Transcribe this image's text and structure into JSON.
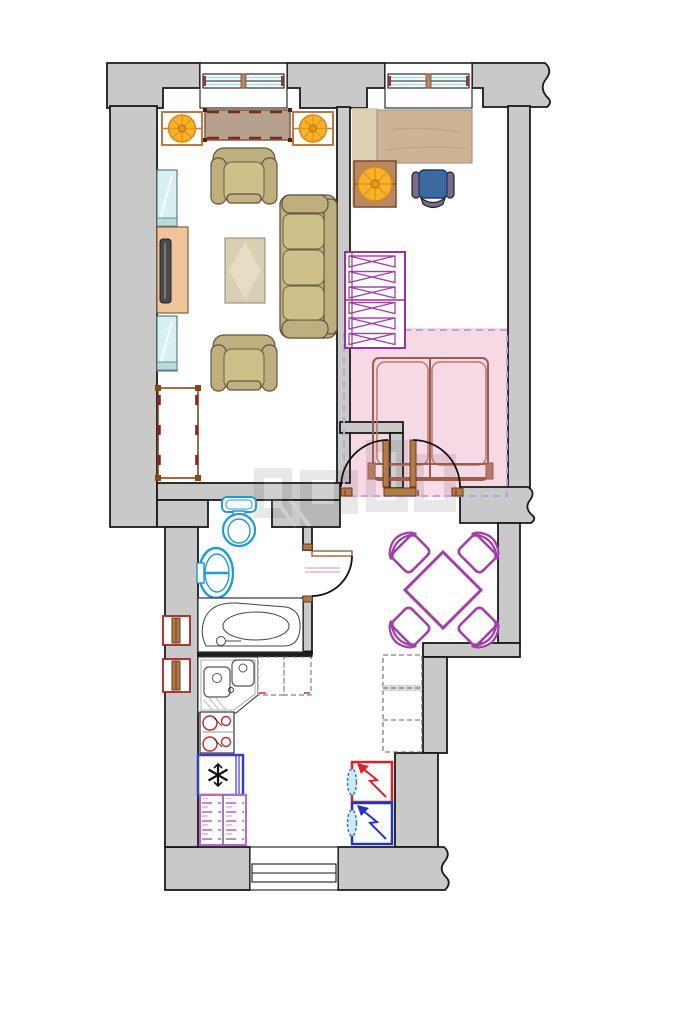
{
  "document": {
    "kind": "apartment floor plan drawing",
    "page_background": "#ffffff",
    "text_labels": []
  },
  "plan": {
    "rooms": [
      {
        "name": "living-room",
        "furniture": [
          "sideboard",
          "decor-wheel-left",
          "decor-wheel-right",
          "armchair-top",
          "sofa-three-seat",
          "coffee-table",
          "armchair-bottom",
          "bench-frame",
          "glass-cabinet-upper",
          "tv-stand",
          "tv",
          "glass-cabinet-lower"
        ],
        "windows": [
          "window-top-left"
        ]
      },
      {
        "name": "bedroom",
        "furniture": [
          "desk",
          "desk-side-mat",
          "side-table-wheel",
          "office-chair",
          "hanger-wardrobe",
          "double-bed"
        ],
        "windows": [
          "window-top-right"
        ],
        "zone_highlight": "pink sleeping zone with dashed border",
        "doors": [
          "closet-door",
          "bedroom-door"
        ]
      },
      {
        "name": "bathroom",
        "fixtures": [
          "toilet",
          "wash-basin",
          "corner-bathtub",
          "wall-vent-upper",
          "wall-vent-lower"
        ],
        "doors": [
          "bathroom-door"
        ]
      },
      {
        "name": "kitchen",
        "fixtures": [
          "corner-sink-unit",
          "counter-dashed-1",
          "counter-dashed-2",
          "cooktop-4-burners",
          "refrigerator-snowflake",
          "linen-dresser"
        ],
        "windows": [
          "window-bottom"
        ]
      },
      {
        "name": "dining-area",
        "furniture": [
          "square-table-rotated",
          "dining-chair-nw",
          "dining-chair-ne",
          "dining-chair-sw",
          "dining-chair-se",
          "tall-dashed-cabinet",
          "electric-heater-red",
          "electric-heater-blue"
        ]
      }
    ],
    "watermark": "faint gray logo blocks near plan center"
  },
  "colors": {
    "wall": "#c9c9c9",
    "outline": "#1a1a1a",
    "pink_zone": "#f6d4e2",
    "zone_border": "#b6a6da",
    "purple": "#a040a8",
    "fixture_blue": "#1f9cd8",
    "chair_blue": "#3c6a9e",
    "wood_desk": "#cdb492",
    "wood_trim": "#c07840",
    "orange": "#f7b12c",
    "sofa": "#c3b183",
    "sofa_dark": "#bfae7e",
    "cushion": "#cec089",
    "sideboard": "#b5a18c",
    "tv_stand": "#eec49a",
    "glass": "#d8f0f2",
    "bed_frame": "#9b5e4a",
    "fridge_border": "#3a3acc",
    "heater_red": "#dd2222",
    "heater_blue": "#2233cc",
    "dresser": "#b869c4",
    "door_wood": "#b07a4a"
  }
}
